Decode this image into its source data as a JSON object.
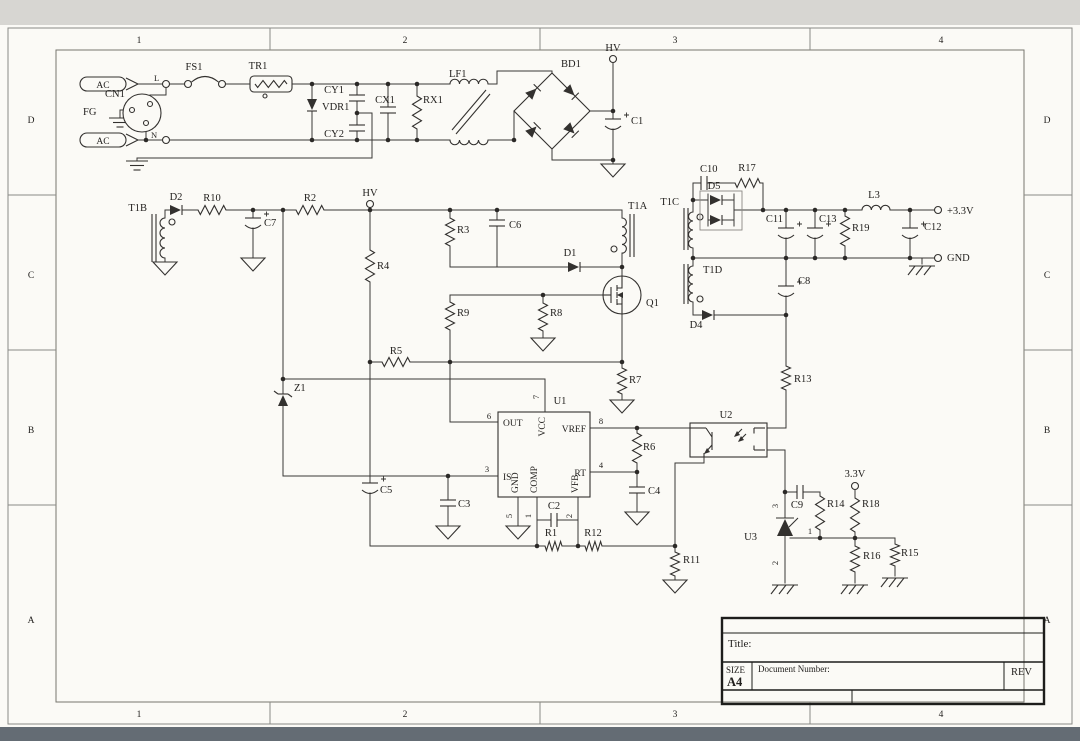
{
  "sheet": {
    "zones_cols": [
      "1",
      "2",
      "3",
      "4"
    ],
    "zones_rows": [
      "D",
      "C",
      "B",
      "A"
    ]
  },
  "title_block": {
    "title_label": "Title:",
    "size_label": "SIZE",
    "size_value": "A4",
    "doc_label": "Document Number:",
    "rev_label": "REV"
  },
  "labels": {
    "ac_l": "AC",
    "ac_n": "AC",
    "term_l": "L",
    "term_n": "N",
    "cn1": "CN1",
    "fg": "FG",
    "fs1": "FS1",
    "tr1": "TR1",
    "vdr1": "VDR1",
    "cy1": "CY1",
    "cy2": "CY2",
    "cx1": "CX1",
    "rx1": "RX1",
    "lf1": "LF1",
    "bd1": "BD1",
    "hv_bridge": "HV",
    "c1": "C1",
    "t1b": "T1B",
    "d2": "D2",
    "r10": "R10",
    "c7": "C7",
    "r2": "R2",
    "hv_aux": "HV",
    "r4": "R4",
    "r3": "R3",
    "c6": "C6",
    "d1": "D1",
    "t1a": "T1A",
    "q1": "Q1",
    "r9": "R9",
    "r8": "R8",
    "r5": "R5",
    "r7": "R7",
    "z1": "Z1",
    "c5": "C5",
    "c3": "C3",
    "u1": "U1",
    "u1_out": "OUT",
    "u1_vcc": "VCC",
    "u1_vref": "VREF",
    "u1_is": "IS",
    "u1_gnd": "GND",
    "u1_comp": "COMP",
    "u1_vfb": "VFB",
    "u1_rt": "RT",
    "u1_p1": "1",
    "u1_p2": "2",
    "u1_p3": "3",
    "u1_p4": "4",
    "u1_p5": "5",
    "u1_p6": "6",
    "u1_p7": "7",
    "u1_p8": "8",
    "c2": "C2",
    "r1": "R1",
    "r12": "R12",
    "r11": "R11",
    "c4": "C4",
    "r6": "R6",
    "u2": "U2",
    "t1c": "T1C",
    "c10": "C10",
    "d5": "D5",
    "r17": "R17",
    "c11": "C11",
    "c13": "C13",
    "r19": "R19",
    "l3": "L3",
    "c12": "C12",
    "out_33": "+3.3V",
    "out_gnd": "GND",
    "t1d": "T1D",
    "d4": "D4",
    "c8": "C8",
    "r13": "R13",
    "u3": "U3",
    "u3_p1": "1",
    "u3_p2": "2",
    "u3_p3": "3",
    "c9": "C9",
    "r14": "R14",
    "bias_33": "3.3V",
    "r18": "R18",
    "r16": "R16",
    "r15": "R15"
  }
}
